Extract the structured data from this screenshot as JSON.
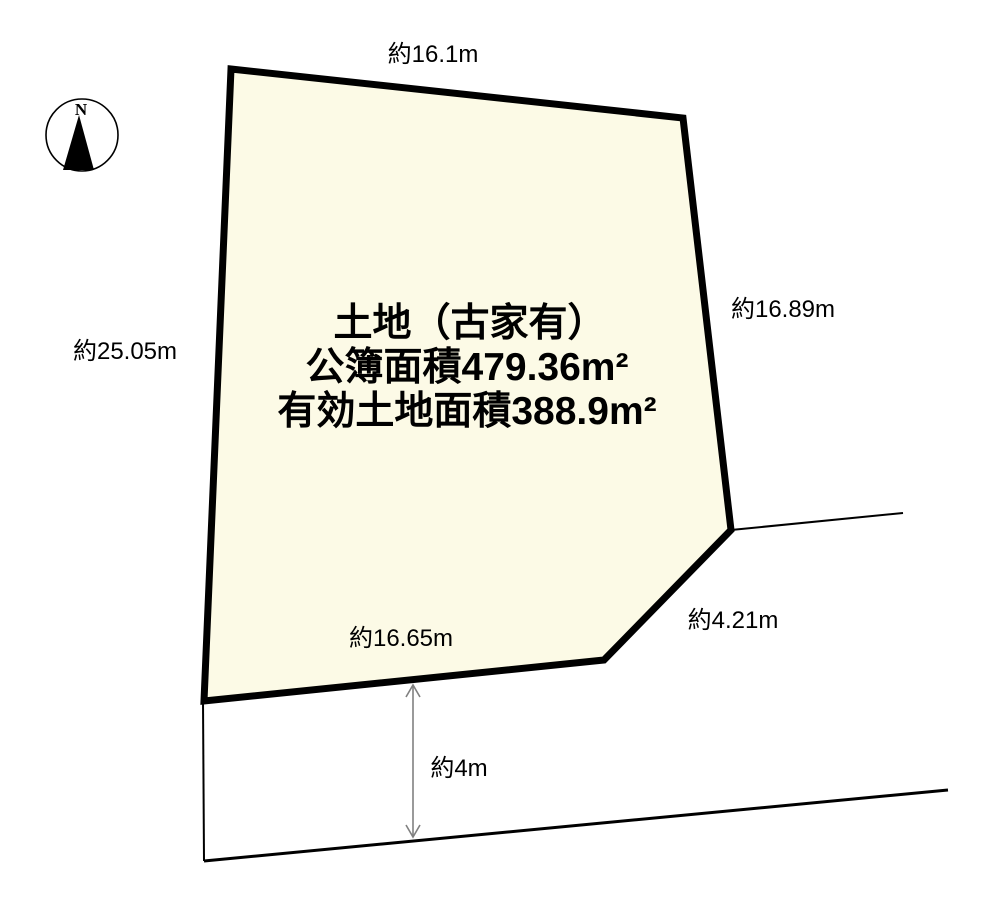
{
  "compass": {
    "north_label": "N"
  },
  "parcel": {
    "line1": "土地（古家有）",
    "line2": "公簿面積479.36m²",
    "line3": "有効土地面積388.9m²",
    "fill_color": "#FCFAE6",
    "border_color": "#000000"
  },
  "dimensions": {
    "top": "約16.1m",
    "right": "約16.89m",
    "left": "約25.05m",
    "bottom": "約16.65m",
    "southeast_diagonal": "約4.21m",
    "road_width": "約4m"
  },
  "colors": {
    "arrow": "#808080",
    "line": "#000000"
  }
}
